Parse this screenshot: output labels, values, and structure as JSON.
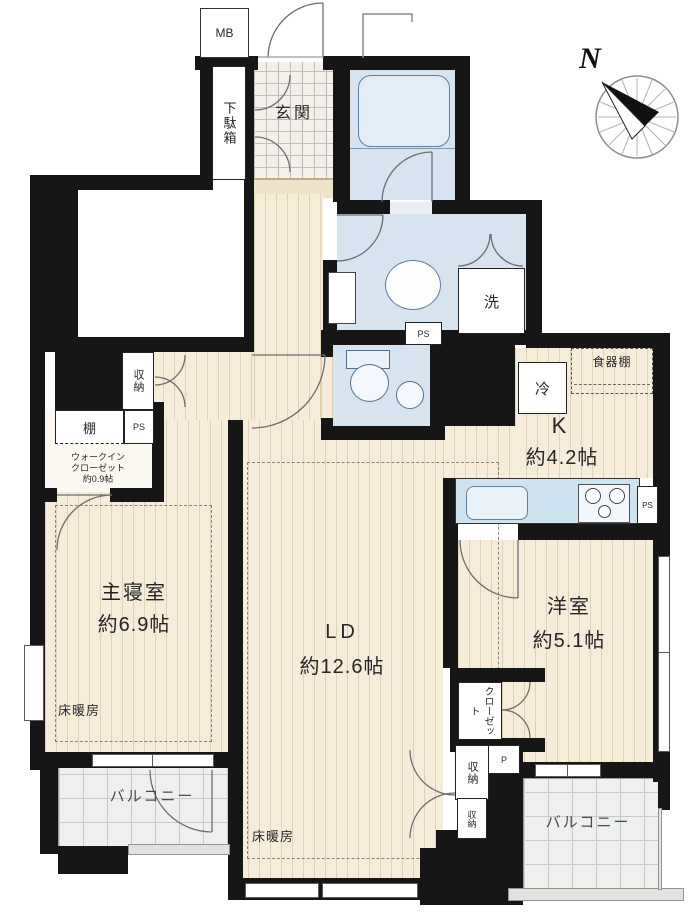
{
  "compass": {
    "north_label": "N"
  },
  "labels": {
    "meter_box": "MB",
    "shoe_cabinet": "下駄箱",
    "entrance": "玄関",
    "washing_machine": "洗",
    "pipe_space": "PS",
    "pipe": "P",
    "refrigerator": "冷",
    "cupboard": "食器棚",
    "storage": "収納",
    "shelf": "棚",
    "floor_heating": "床暖房",
    "closet": "クローゼット",
    "balcony": "バルコニー"
  },
  "rooms": {
    "kitchen": {
      "name": "K",
      "size": "約4.2帖"
    },
    "master_bedroom": {
      "name": "主寝室",
      "size": "約6.9帖"
    },
    "living_dining": {
      "name": "LD",
      "size": "約12.6帖"
    },
    "western_room": {
      "name": "洋室",
      "size": "約5.1帖"
    },
    "walk_in_closet": {
      "line1": "ウォークイン",
      "line2": "クローゼット",
      "size": "約0.9帖"
    }
  },
  "colors": {
    "wall": "#161616",
    "wet_room_blue": "#d7e4f0",
    "wood_floor": "#f6ecda",
    "balcony_gray": "#eef0ed"
  }
}
